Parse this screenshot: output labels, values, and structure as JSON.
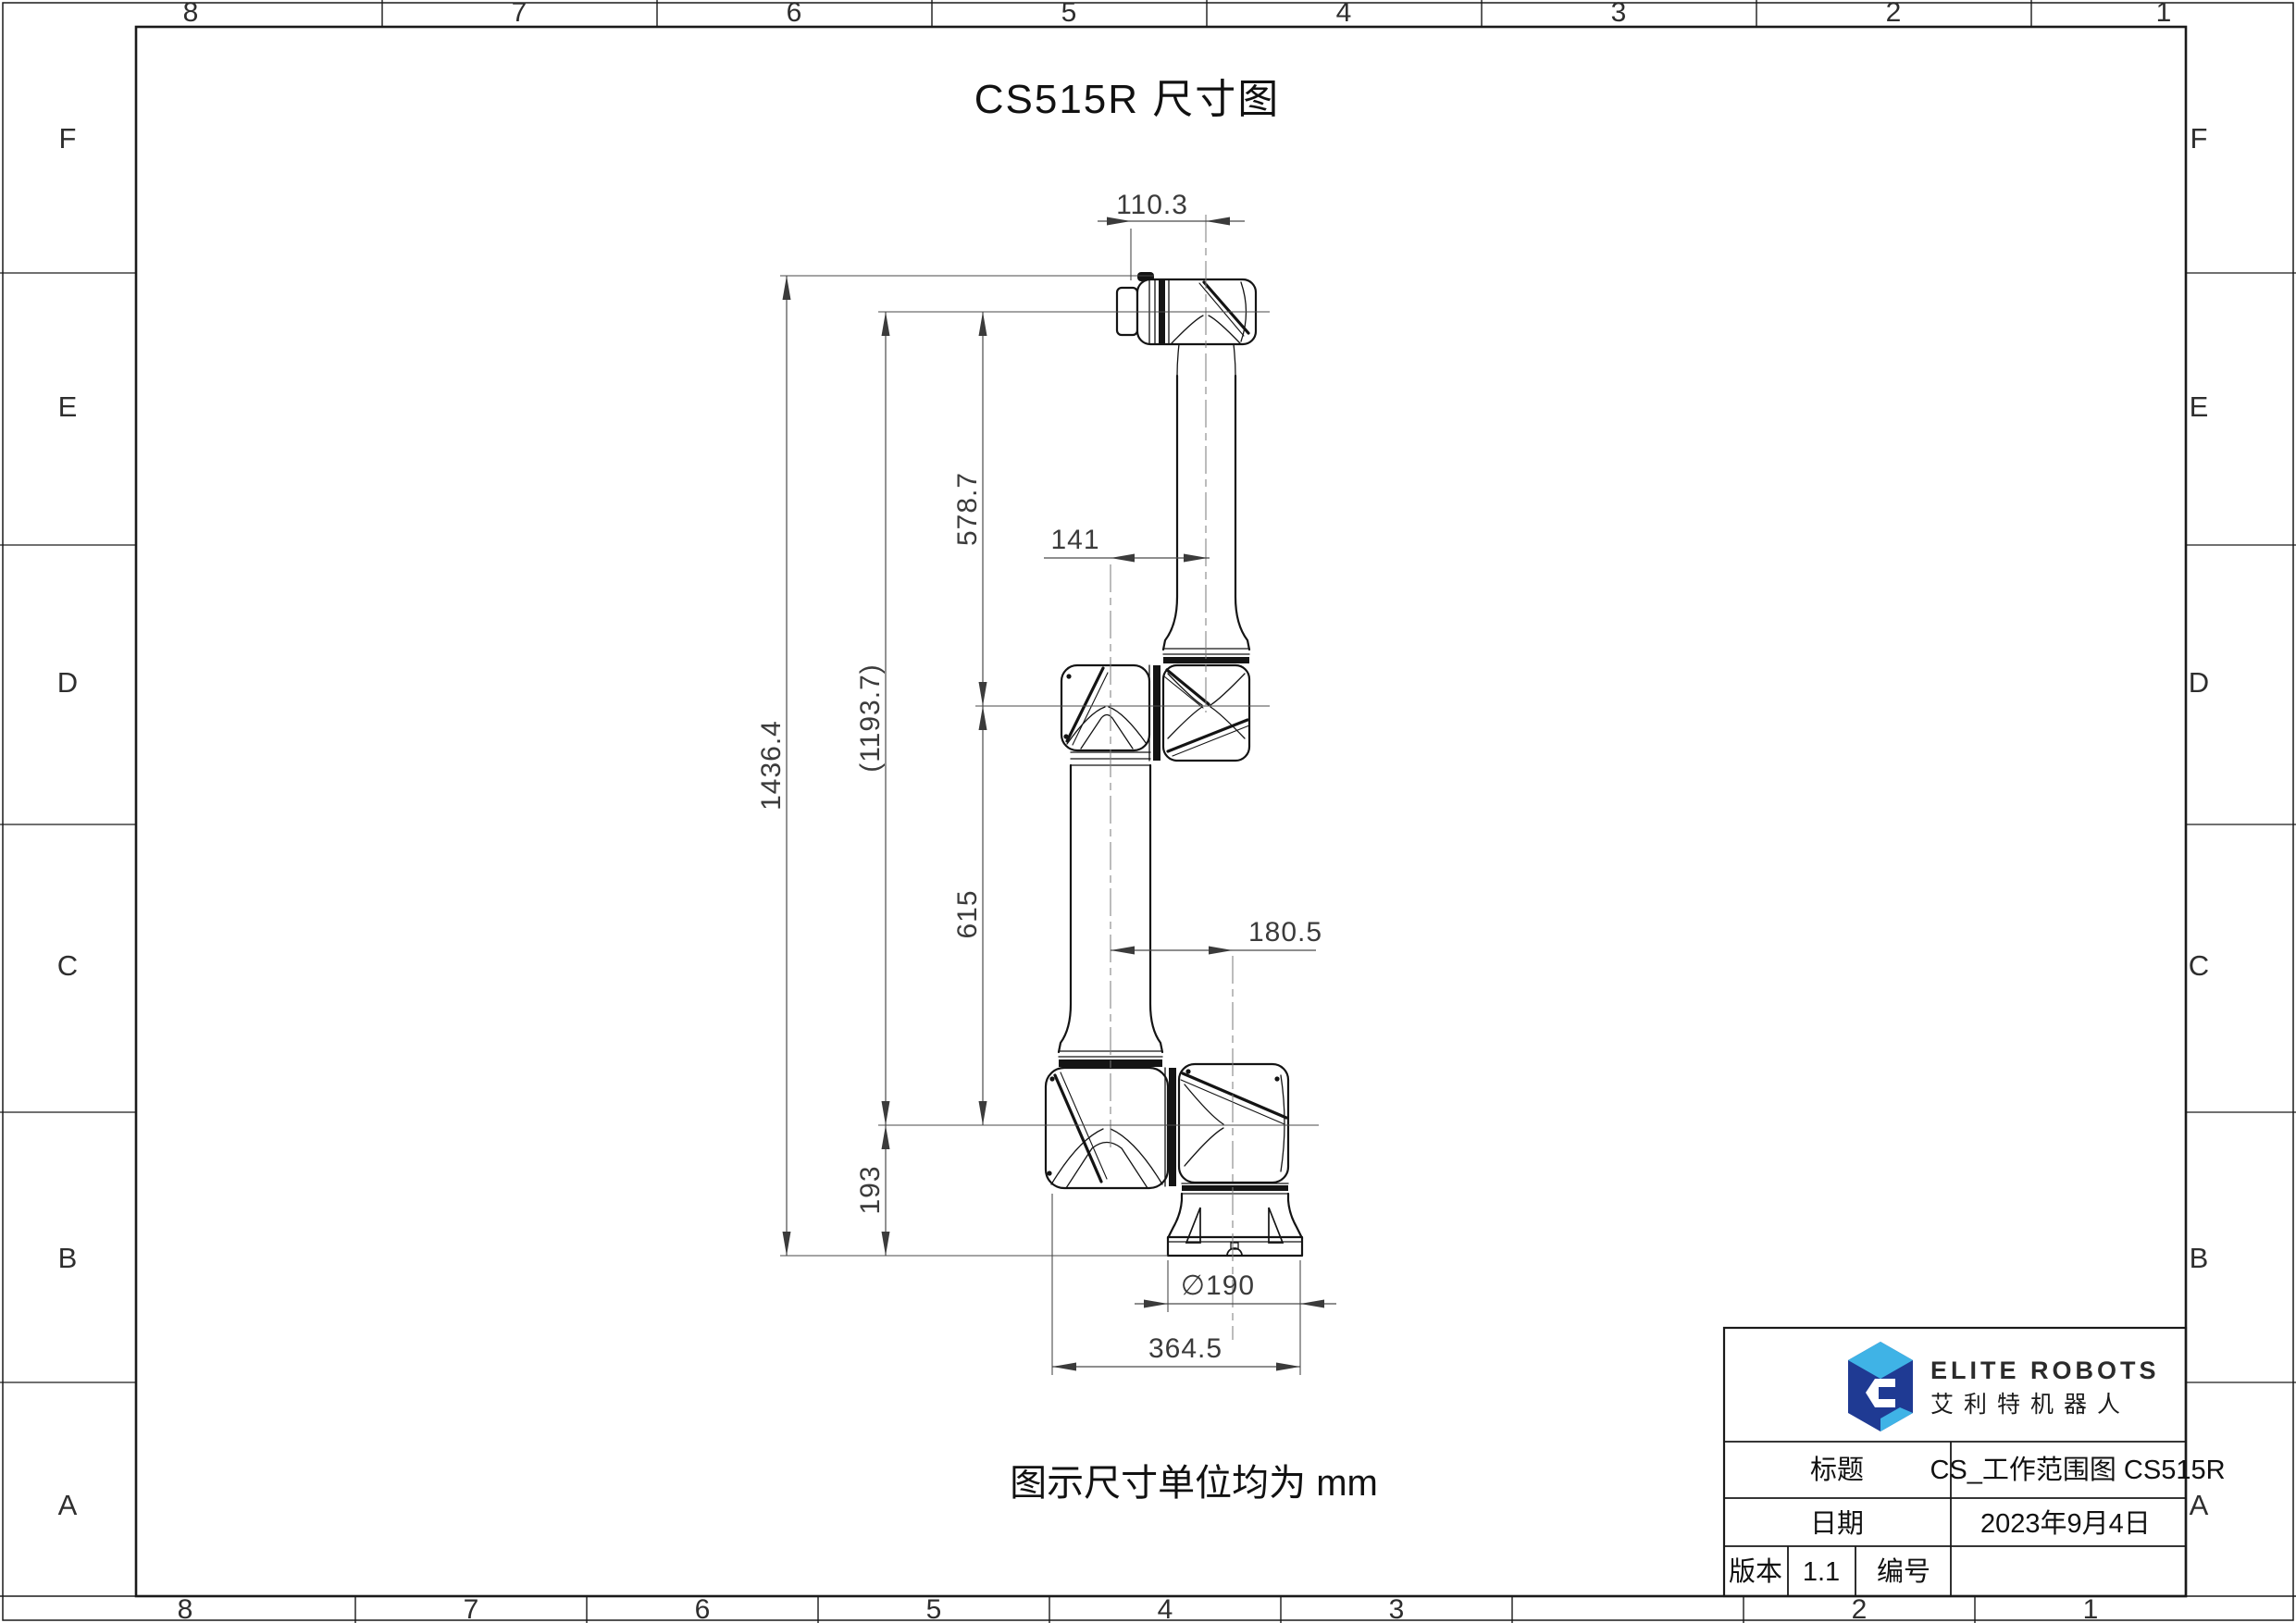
{
  "page": {
    "title": "CS515R 尺寸图",
    "note": "图示尺寸单位均为 mm"
  },
  "border": {
    "numbers": [
      "8",
      "7",
      "6",
      "5",
      "4",
      "3",
      "2",
      "1"
    ],
    "letters": [
      "F",
      "E",
      "D",
      "C",
      "B",
      "A"
    ]
  },
  "dimensions": {
    "wrist_offset": "110.3",
    "upper_arm_length": "578.7",
    "elbow_offset": "141",
    "total_height": "1436.4",
    "wrist_to_shoulder": "(1193.7)",
    "lower_arm_length": "615",
    "shoulder_offset": "180.5",
    "base_height": "193",
    "base_diameter": "∅190",
    "footprint_width": "364.5"
  },
  "title_block": {
    "brand_en": "ELITE ROBOTS",
    "brand_cn": "艾利特机器人",
    "title_label": "标题",
    "title_value": "CS_工作范围图  CS515R",
    "date_label": "日期",
    "date_value": "2023年9月4日",
    "version_label": "版本",
    "version_value": "1.1",
    "number_label": "编号",
    "number_value": ""
  },
  "colors": {
    "logo_navy": "#1F3A93",
    "logo_blue": "#3FB3E6",
    "line": "#141414",
    "dim_text": "#3b3b3b"
  }
}
